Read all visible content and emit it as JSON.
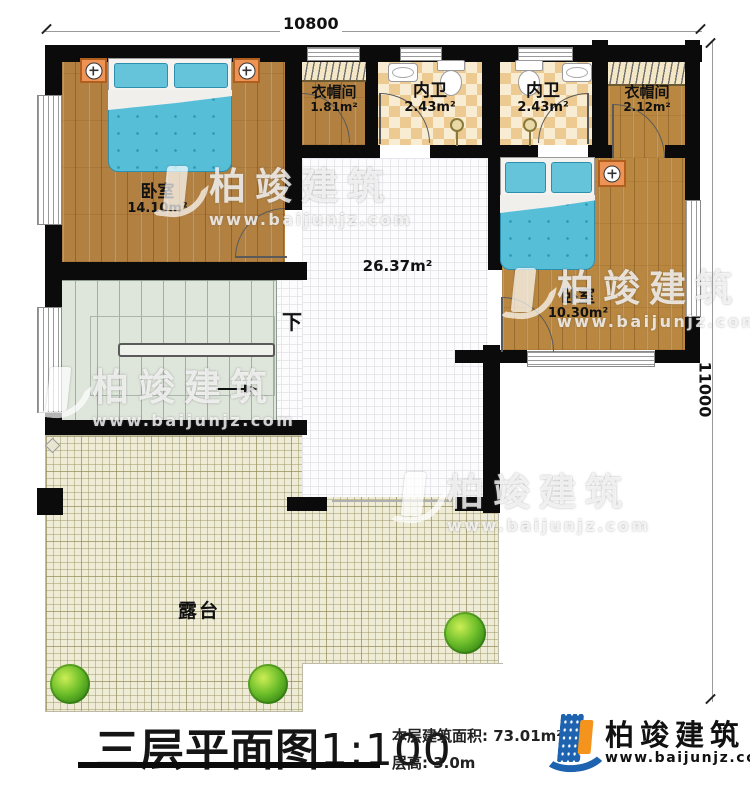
{
  "dimensions": {
    "top_width": "10800",
    "right_height": "11000"
  },
  "rooms": {
    "bedroom_left": {
      "name": "卧室",
      "area": "14.10m²"
    },
    "closet_left": {
      "name": "衣帽间",
      "area": "1.81m²"
    },
    "bath_left": {
      "name": "内卫",
      "area": "2.43m²"
    },
    "bath_right": {
      "name": "内卫",
      "area": "2.43m²"
    },
    "closet_right": {
      "name": "衣帽间",
      "area": "2.12m²"
    },
    "bedroom_right": {
      "name": "卧室",
      "area": "10.30m²"
    },
    "hall": {
      "area": "26.37m²"
    },
    "stairs": {
      "direction_label": "下"
    },
    "terrace": {
      "name": "露台"
    }
  },
  "watermark": {
    "name": "柏竣建筑",
    "url": "www.baijunjz.com"
  },
  "title_block": {
    "title": "三层平面图",
    "scale": "1:100",
    "floor_area_label": "本层建筑面积:",
    "floor_area_value": "73.01m²",
    "floor_height_label": "层高:",
    "floor_height_value": "3.0m"
  },
  "brand": {
    "name": "柏竣建筑",
    "url": "www.baijunjz.com"
  }
}
